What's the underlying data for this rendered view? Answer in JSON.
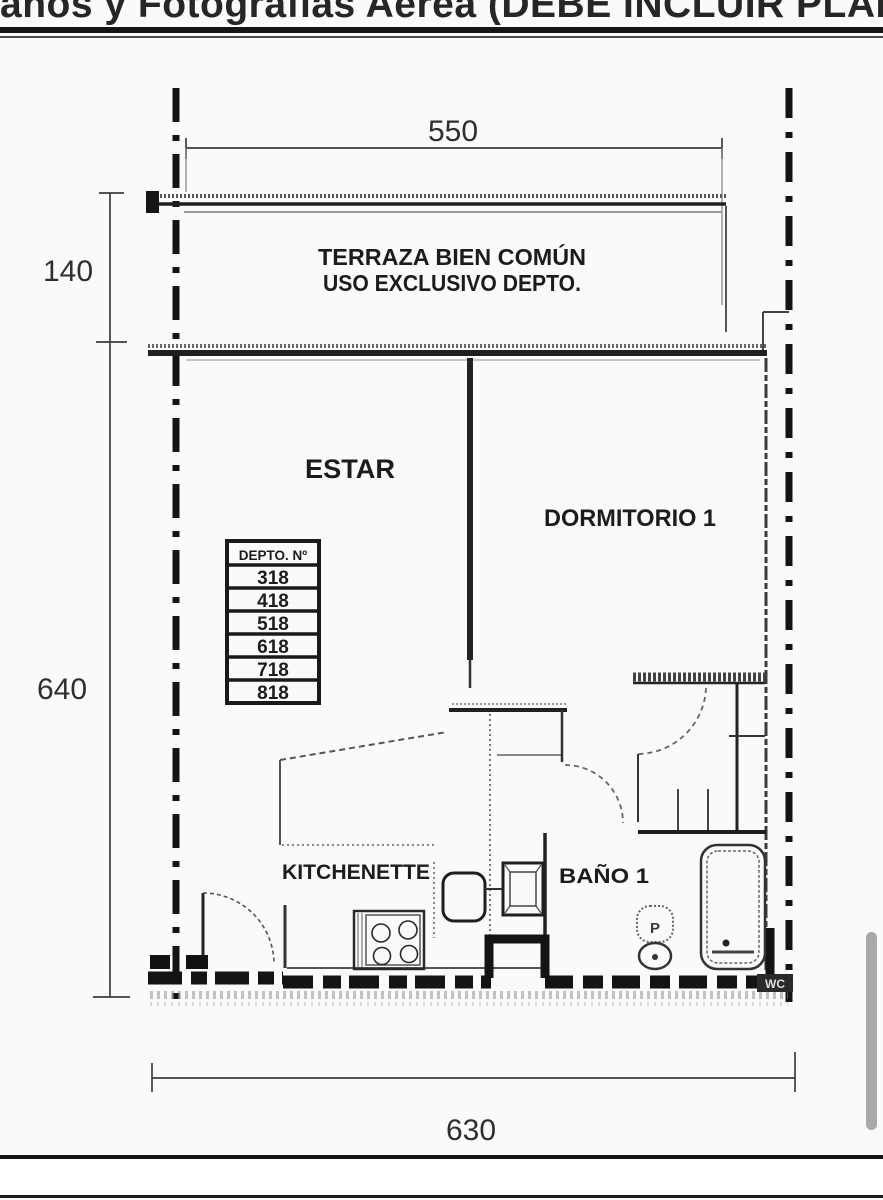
{
  "header": {
    "title_clipped": "anos y Fotografías Aérea (DEBE INCLUIR PLANO DEL TE"
  },
  "plan": {
    "room_labels": {
      "terraza_line1": "TERRAZA BIEN COMÚN",
      "terraza_line2": "USO EXCLUSIVO DEPTO.",
      "estar": "ESTAR",
      "dormitorio": "DORMITORIO 1",
      "kitchenette": "KITCHENETTE",
      "bano": "BAÑO 1",
      "wc": "WC"
    },
    "dimensions": {
      "terraza_width": "550",
      "terraza_depth": "140",
      "apartment_depth": "640",
      "apartment_width": "630"
    },
    "depto_table": {
      "header": "DEPTO. Nº",
      "rows": [
        "318",
        "418",
        "518",
        "618",
        "718",
        "818"
      ]
    },
    "fixture_marks": {
      "toilet": "P"
    }
  },
  "colors": {
    "ink": "#1f1f1f",
    "paper": "#fafafa",
    "scrollbar": "#a9a9a9"
  }
}
